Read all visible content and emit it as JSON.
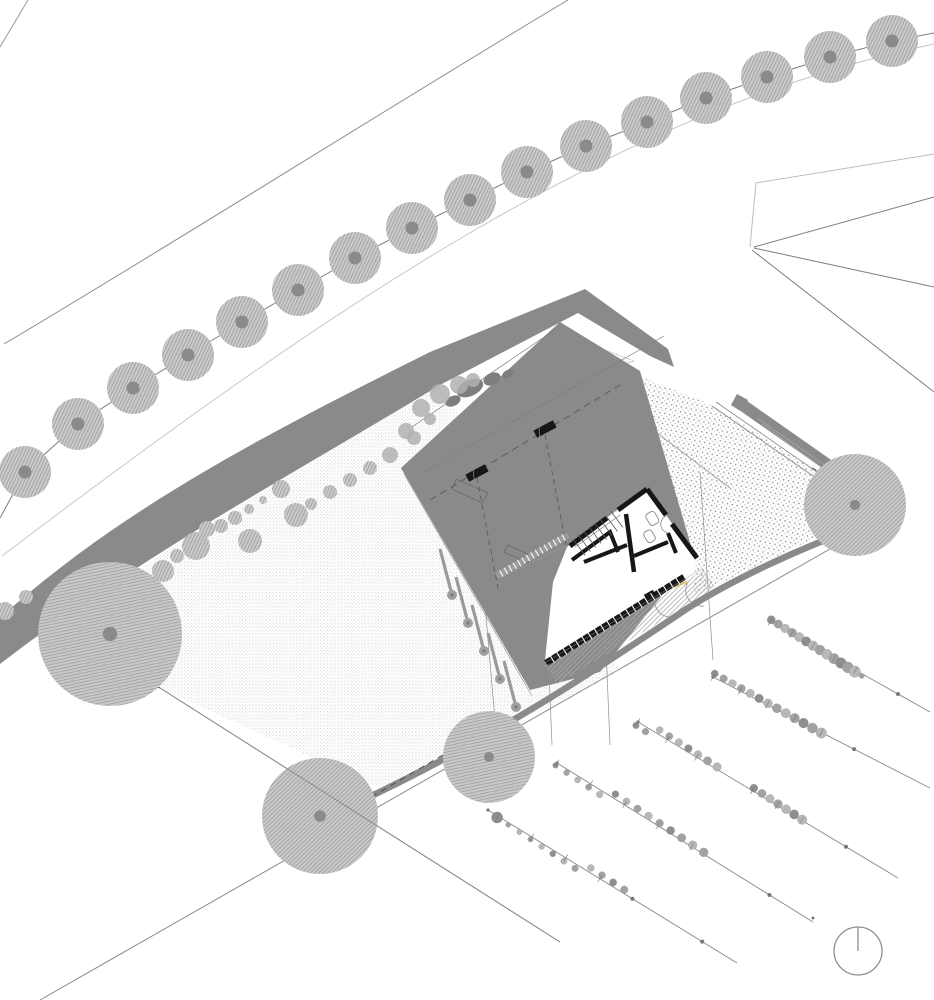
{
  "document": {
    "type": "architectural-site-plan",
    "description": "Monochrome architectural site plan: curved street with row of hatched trees, grey retaining band, house with grey roof plan and exposed floor plan, stippled lawn with large trees, gravel courtyard with L-wall, vineyard rows, north indicator circle",
    "visible_text": []
  },
  "palette": {
    "background": "#ffffff",
    "concrete": "#8a8a8a",
    "roof": "#8a8a8a",
    "roof_shadow": "#7e7e7e",
    "wall_black": "#161616",
    "line_dark": "#7d7d7d",
    "line_mid": "#999999",
    "line_light": "#bdbdbd",
    "tree_fill": "#cbcbcb",
    "tree_hatch": "#9f9f9f",
    "tree_dot": "#8a8a8a",
    "lawn_dot": "#c4c4c4",
    "gravel_dot": "#9a9a9a",
    "deck_hatch": "#ababab",
    "plant_dark": "#8e8e8e",
    "plant_mid": "#a2a2a2",
    "plant_light": "#b8b8b8",
    "accent_yellow": "#d9c87c",
    "compass_stroke": "#8f8f8f"
  },
  "geometry": {
    "street_trees": {
      "r": 26,
      "dot_r": 6.5,
      "items": [
        [
          25,
          472
        ],
        [
          78,
          424
        ],
        [
          133,
          388
        ],
        [
          188,
          355
        ],
        [
          242,
          322
        ],
        [
          298,
          290
        ],
        [
          355,
          258
        ],
        [
          412,
          228
        ],
        [
          470,
          200
        ],
        [
          527,
          172
        ],
        [
          586,
          146
        ],
        [
          647,
          122
        ],
        [
          706,
          98
        ],
        [
          767,
          77
        ],
        [
          830,
          57
        ],
        [
          892,
          41
        ]
      ]
    },
    "tree_line": {
      "pre": [
        0,
        518
      ],
      "post": [
        934,
        33
      ]
    },
    "lawn_trees": [
      [
        110,
        634,
        72
      ],
      [
        320,
        816,
        58
      ],
      [
        489,
        757,
        46
      ],
      [
        855,
        505,
        51
      ]
    ],
    "shrubs": [
      [
        5,
        611,
        9
      ],
      [
        26,
        597,
        7
      ],
      [
        163,
        571,
        11
      ],
      [
        177,
        556,
        7
      ],
      [
        196,
        546,
        14
      ],
      [
        207,
        529,
        8
      ],
      [
        221,
        526,
        7
      ],
      [
        235,
        518,
        7
      ],
      [
        249,
        509,
        5
      ],
      [
        263,
        500,
        4
      ],
      [
        281,
        489,
        9
      ],
      [
        296,
        515,
        12
      ],
      [
        250,
        541,
        12
      ],
      [
        311,
        504,
        6
      ],
      [
        330,
        492,
        7
      ],
      [
        350,
        480,
        7
      ],
      [
        370,
        468,
        7
      ]
    ],
    "shrubs_roof": [
      [
        390,
        455,
        8
      ],
      [
        406,
        431,
        8
      ],
      [
        421,
        408,
        9
      ],
      [
        440,
        394,
        10
      ],
      [
        459,
        385,
        9
      ],
      [
        473,
        380,
        7
      ],
      [
        430,
        419,
        6
      ],
      [
        414,
        438,
        7
      ]
    ],
    "roof_blobs": [
      [
        470,
        388,
        14,
        8
      ],
      [
        492,
        379,
        9,
        6
      ],
      [
        453,
        401,
        8,
        5
      ],
      [
        508,
        374,
        6,
        4
      ]
    ],
    "columns": {
      "bars": [
        [
          440,
          549
        ],
        [
          456,
          577
        ],
        [
          472,
          605
        ],
        [
          488,
          633
        ],
        [
          504,
          661
        ]
      ],
      "dx": 11,
      "dy": 42,
      "blob_r": 5
    },
    "vineyard_rows": [
      {
        "line": [
          770,
          622,
          930,
          712
        ],
        "clusters": [
          [
            0,
            0.58,
            14
          ]
        ],
        "dots": [
          0.8
        ]
      },
      {
        "line": [
          713,
          677,
          930,
          788
        ],
        "clusters": [
          [
            0,
            0.5,
            13
          ]
        ],
        "dots": [
          0.65
        ]
      },
      {
        "line": [
          638,
          722,
          898,
          878
        ],
        "clusters": [
          [
            0,
            0.3,
            9
          ],
          [
            0.44,
            0.63,
            7
          ]
        ],
        "dots": [
          0.8
        ]
      },
      {
        "line": [
          557,
          763,
          813,
          922
        ],
        "clusters": [
          [
            0,
            0.57,
            14
          ]
        ],
        "dots": [
          0.83
        ]
      },
      {
        "line": [
          488,
          810,
          737,
          963
        ],
        "clusters": [
          [
            0.04,
            0.54,
            12
          ]
        ],
        "dots": [
          0.58,
          0.86
        ]
      },
      {
        "line": [
          160,
          688,
          560,
          942
        ],
        "clusters": [],
        "dots": []
      }
    ],
    "mullion_bands": [
      {
        "x1": 546,
        "y1": 663,
        "x2": 684,
        "y2": 577,
        "n": 22,
        "w": 6.5,
        "color": "#161616",
        "tick": 8
      },
      {
        "x1": 497,
        "y1": 576,
        "x2": 568,
        "y2": 535,
        "n": 16,
        "w": 6,
        "color": "#9c9c9c",
        "tick": 7
      }
    ],
    "stairs": {
      "x": 573,
      "y": 539,
      "dx": 5.4,
      "dy": -4,
      "tx": 12,
      "ty": 16.4,
      "n": 8
    },
    "compass": {
      "cx": 858,
      "cy": 951,
      "r": 24
    },
    "misc_dots": [
      [
        813,
        918
      ]
    ]
  }
}
